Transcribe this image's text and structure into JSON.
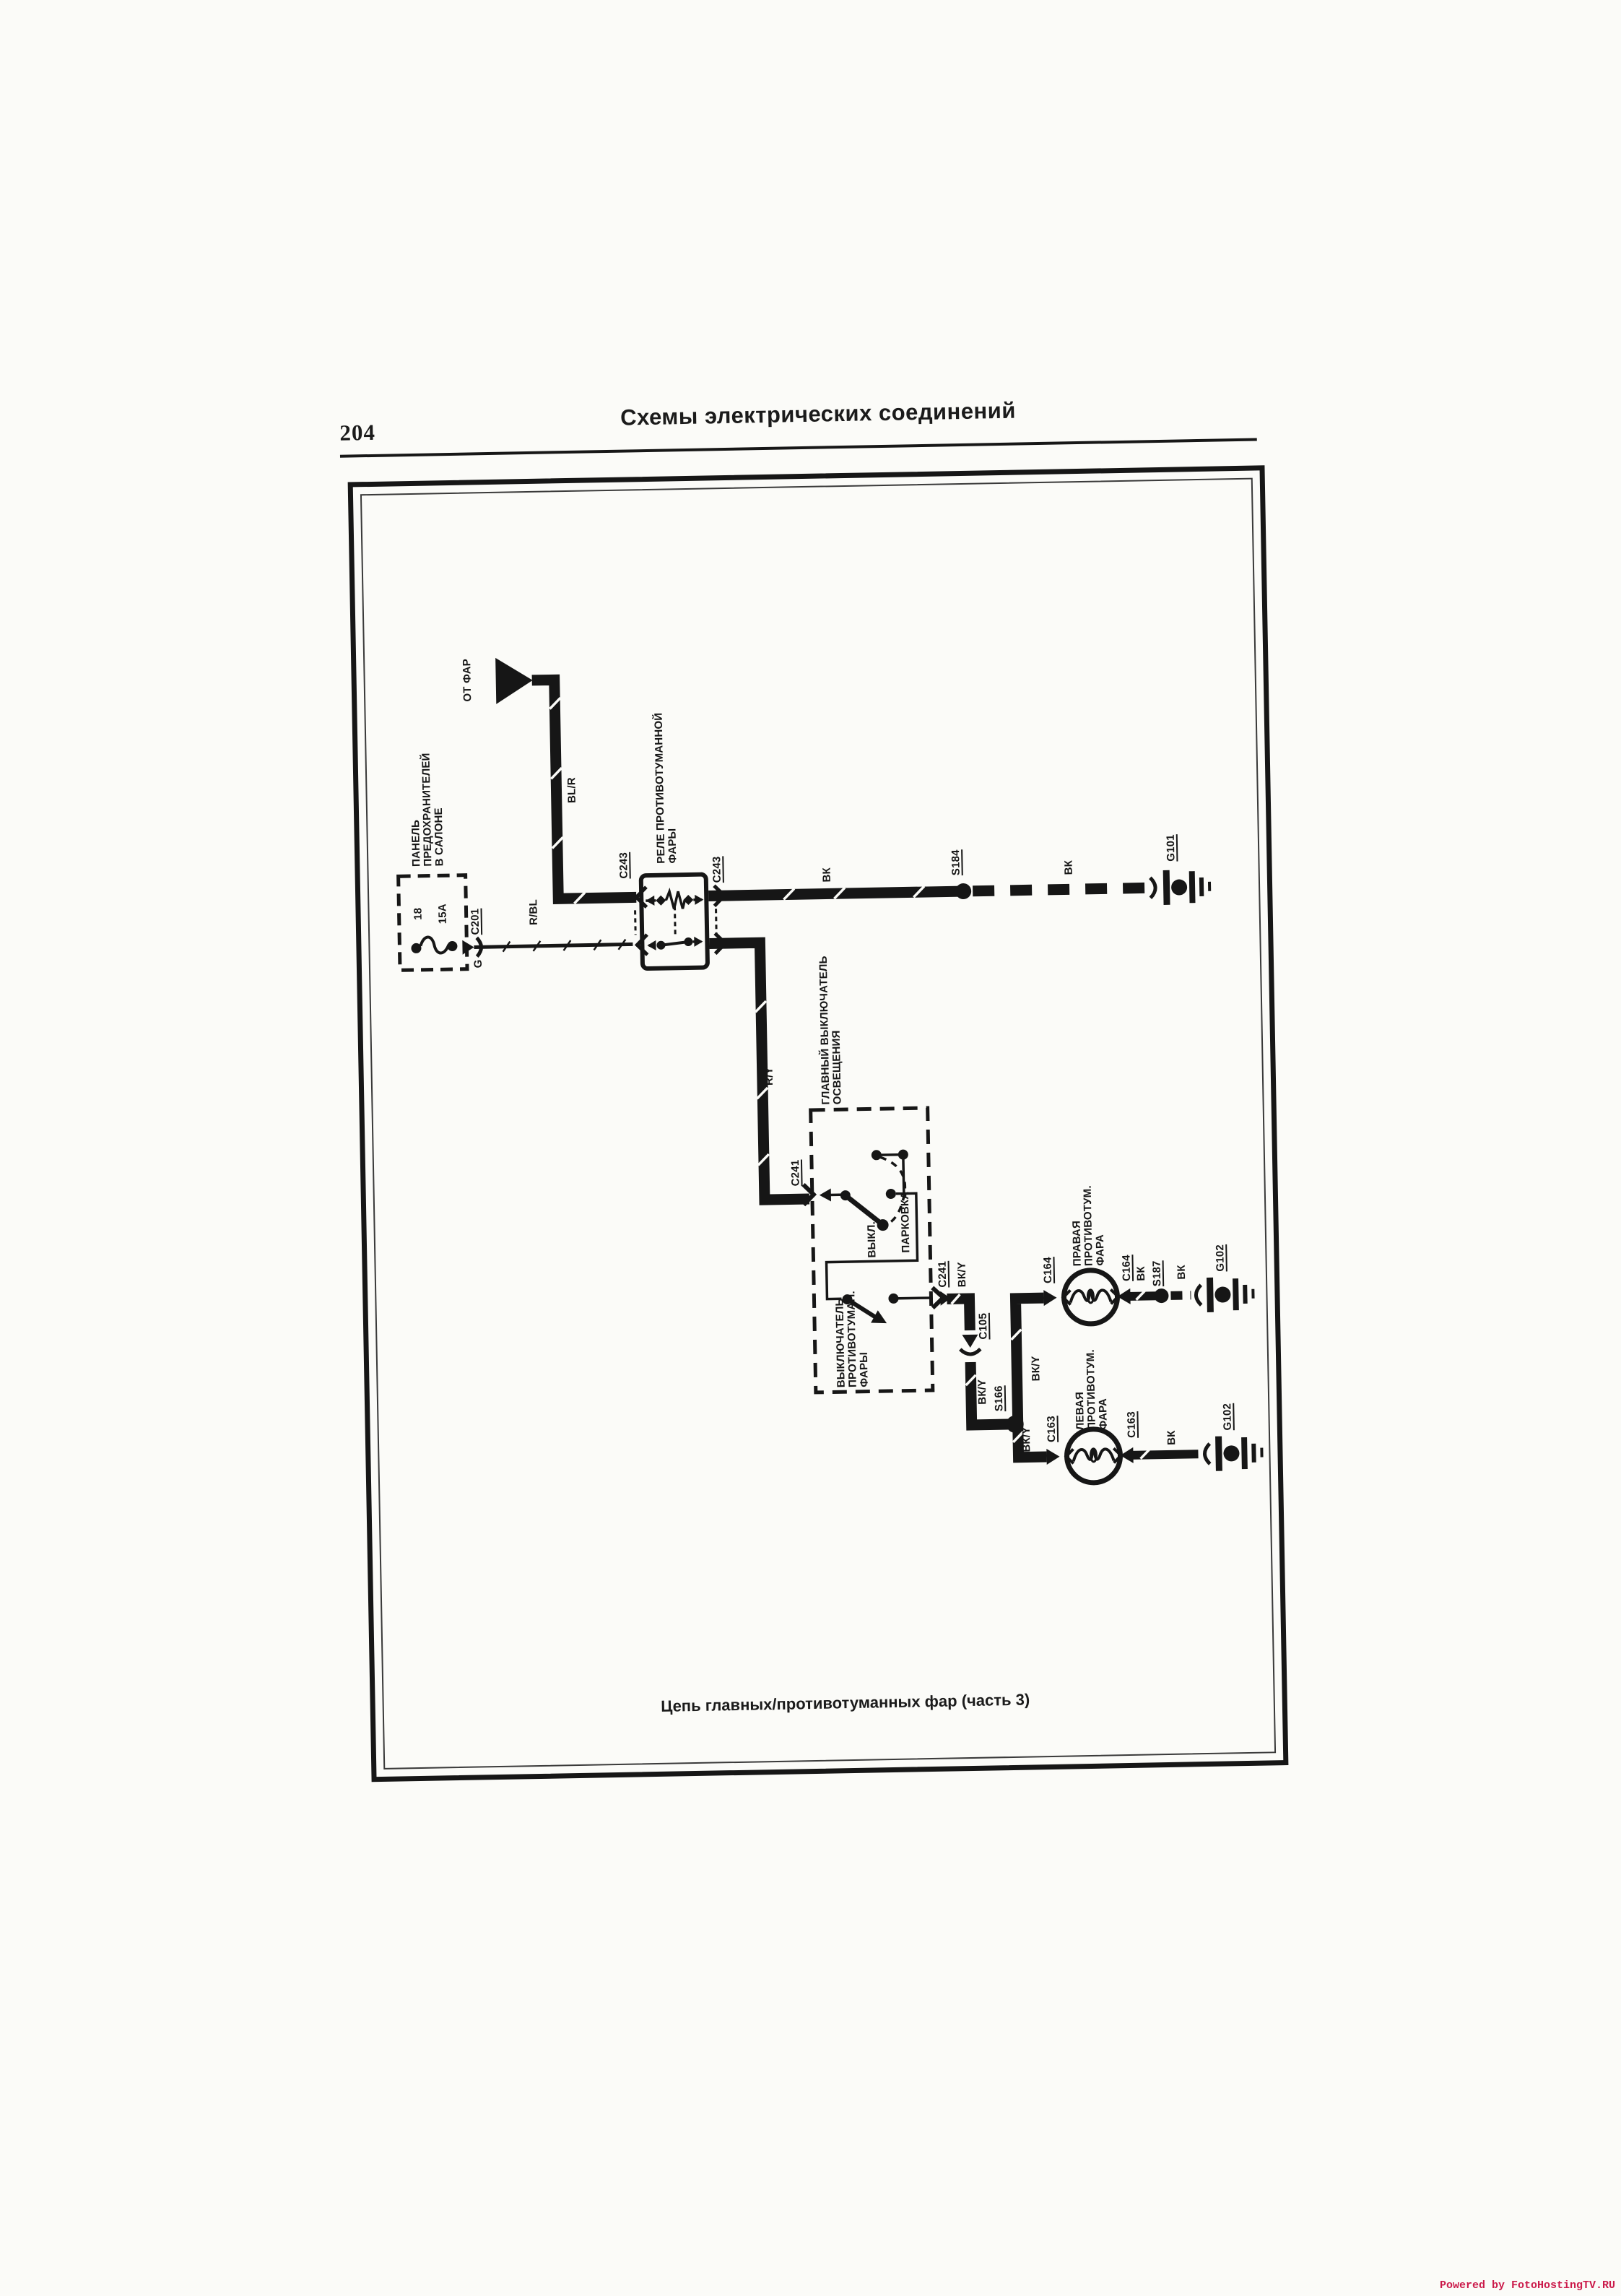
{
  "page": {
    "number": "204",
    "title": "Схемы  электрических  соединений",
    "caption": "Цепь главных/противотуманных фар (часть 3)",
    "watermark": "Powered by FotoHostingTV.RU"
  },
  "colors": {
    "ink": "#161616",
    "paper": "#fbfbf8",
    "watermark": "#cb1a4a"
  },
  "components": {
    "source_arrow": "ОТ ФАР",
    "fuse_panel": {
      "label": "ПАНЕЛЬ\nПРЕДОХРАНИТЕЛЕЙ\nВ САЛОНЕ",
      "fuse_position": "18",
      "fuse_rating": "15A",
      "connector": "C201"
    },
    "relay": {
      "label": "РЕЛЕ ПРОТИВОТУМАННОЙ\nФАРЫ",
      "connector": "C243"
    },
    "main_switch": {
      "label": "ГЛАВНЫЙ ВЫКЛЮЧАТЕЛЬ\nОСВЕЩЕНИЯ",
      "connector": "C241",
      "position_off": "ВЫКЛ.",
      "position_parking": "ПАРКОВКА"
    },
    "fog_switch": {
      "label": "ВЫКЛЮЧАТЕЛЬ\nПРОТИВОТУМАН.\nФАРЫ"
    },
    "inline_connector": "C105",
    "right_lamp": {
      "label": "ПРАВАЯ\nПРОТИВОТУМ.\nФАРА",
      "connector": "C164"
    },
    "left_lamp": {
      "label": "ЛЕВАЯ\nПРОТИВОТУМ.\nФАРА",
      "connector": "C163"
    },
    "splices": {
      "s184": "S184",
      "s166": "S166",
      "s187": "S187"
    },
    "grounds": {
      "g101": "G101",
      "g102": "G102"
    }
  },
  "wires": {
    "bl_r": "BL/R",
    "r_bl": "R/BL",
    "g": "G",
    "r_y": "R/Y",
    "bk": "ВК",
    "bk_y": "ВК/Y"
  }
}
